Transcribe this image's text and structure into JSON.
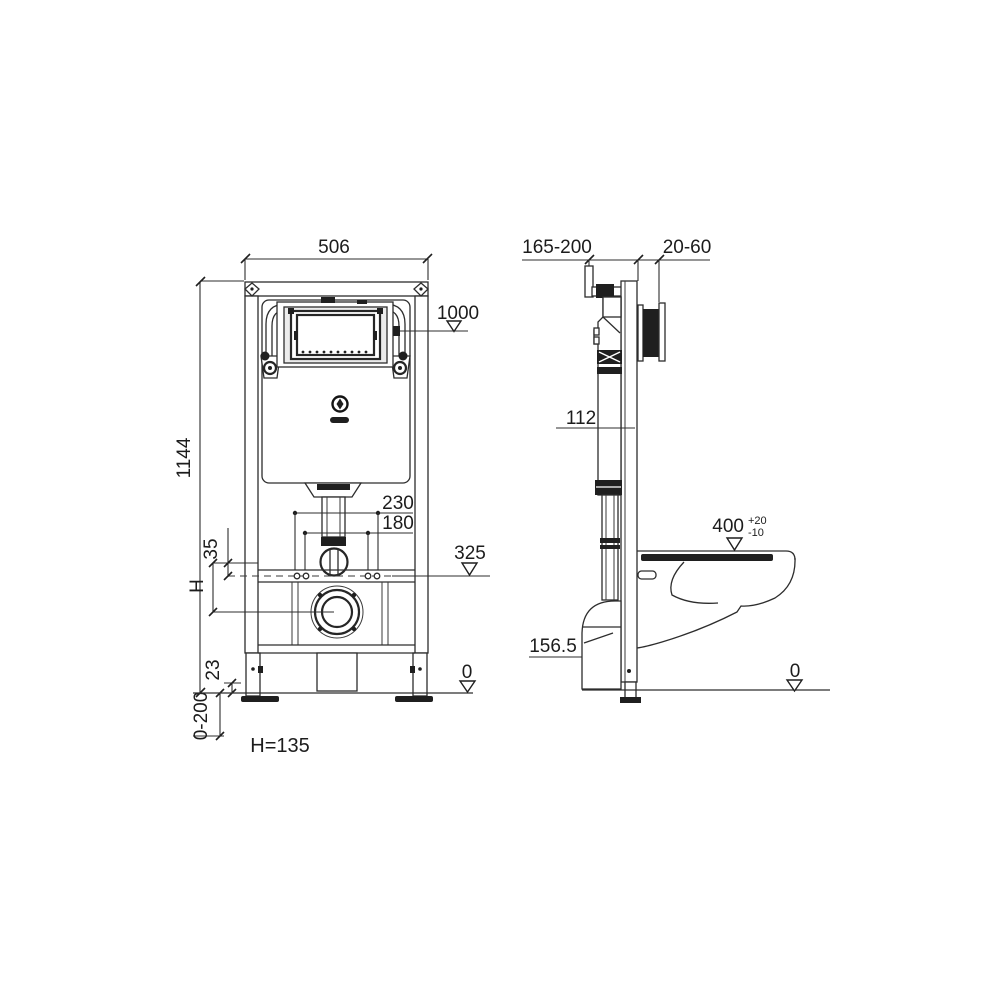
{
  "drawing": {
    "front": {
      "width": "506",
      "height": "1144",
      "flush_plate_level": "1000",
      "hole_spacing_outer": "230",
      "hole_spacing_inner": "180",
      "offset_35": "35",
      "h_symbol": "H",
      "level_325": "325",
      "level_0": "0",
      "bottom_clearance": "23",
      "adjust_range": "0-200",
      "h_equation": "H=135"
    },
    "side": {
      "frame_depth": "165-200",
      "wall_finish": "20-60",
      "cistern_depth": "112",
      "bowl_height": "400",
      "bowl_height_plus": "+20",
      "bowl_height_minus": "-10",
      "outlet_height": "156.5",
      "level_0": "0"
    }
  }
}
